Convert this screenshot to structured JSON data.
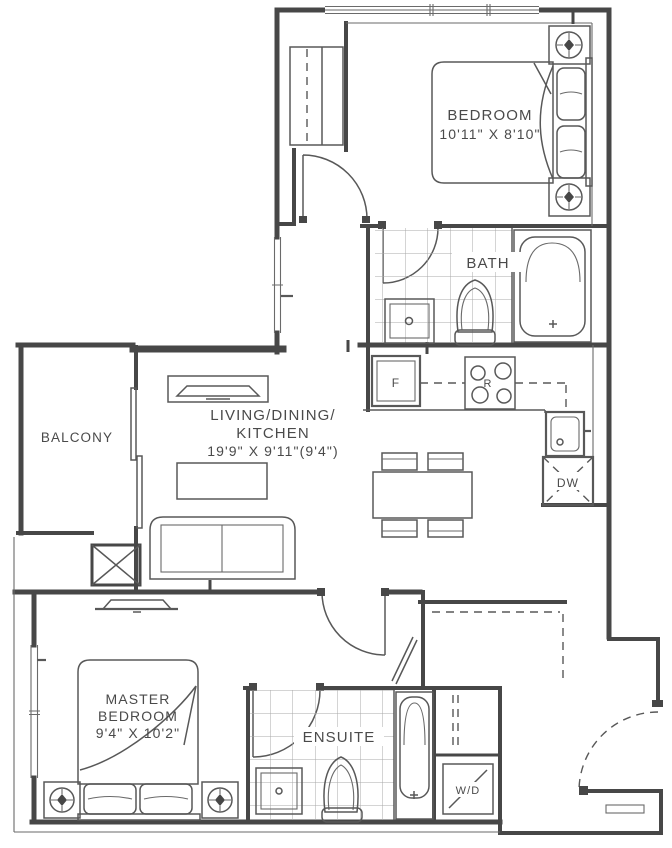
{
  "colors": {
    "background": "#ffffff",
    "wall_line": "#474747",
    "furniture_line": "#585858",
    "tile_line": "#a0a0a0",
    "text": "#4a4a4a"
  },
  "rooms": {
    "bedroom": {
      "label": "BEDROOM",
      "dimensions": "10'11\" X 8'10\""
    },
    "bath": {
      "label": "BATH"
    },
    "living_dining_kitchen": {
      "label_line1": "LIVING/DINING/",
      "label_line2": "KITCHEN",
      "dimensions": "19'9\" X 9'11\"(9'4\")"
    },
    "balcony": {
      "label": "BALCONY"
    },
    "master_bedroom": {
      "label_line1": "MASTER",
      "label_line2": "BEDROOM",
      "dimensions": "9'4\" X 10'2\""
    },
    "ensuite": {
      "label": "ENSUITE"
    }
  },
  "appliances": {
    "fridge_label": "F",
    "range_label": "R",
    "dishwasher_label": "DW",
    "washer_dryer_label": "W/D"
  }
}
